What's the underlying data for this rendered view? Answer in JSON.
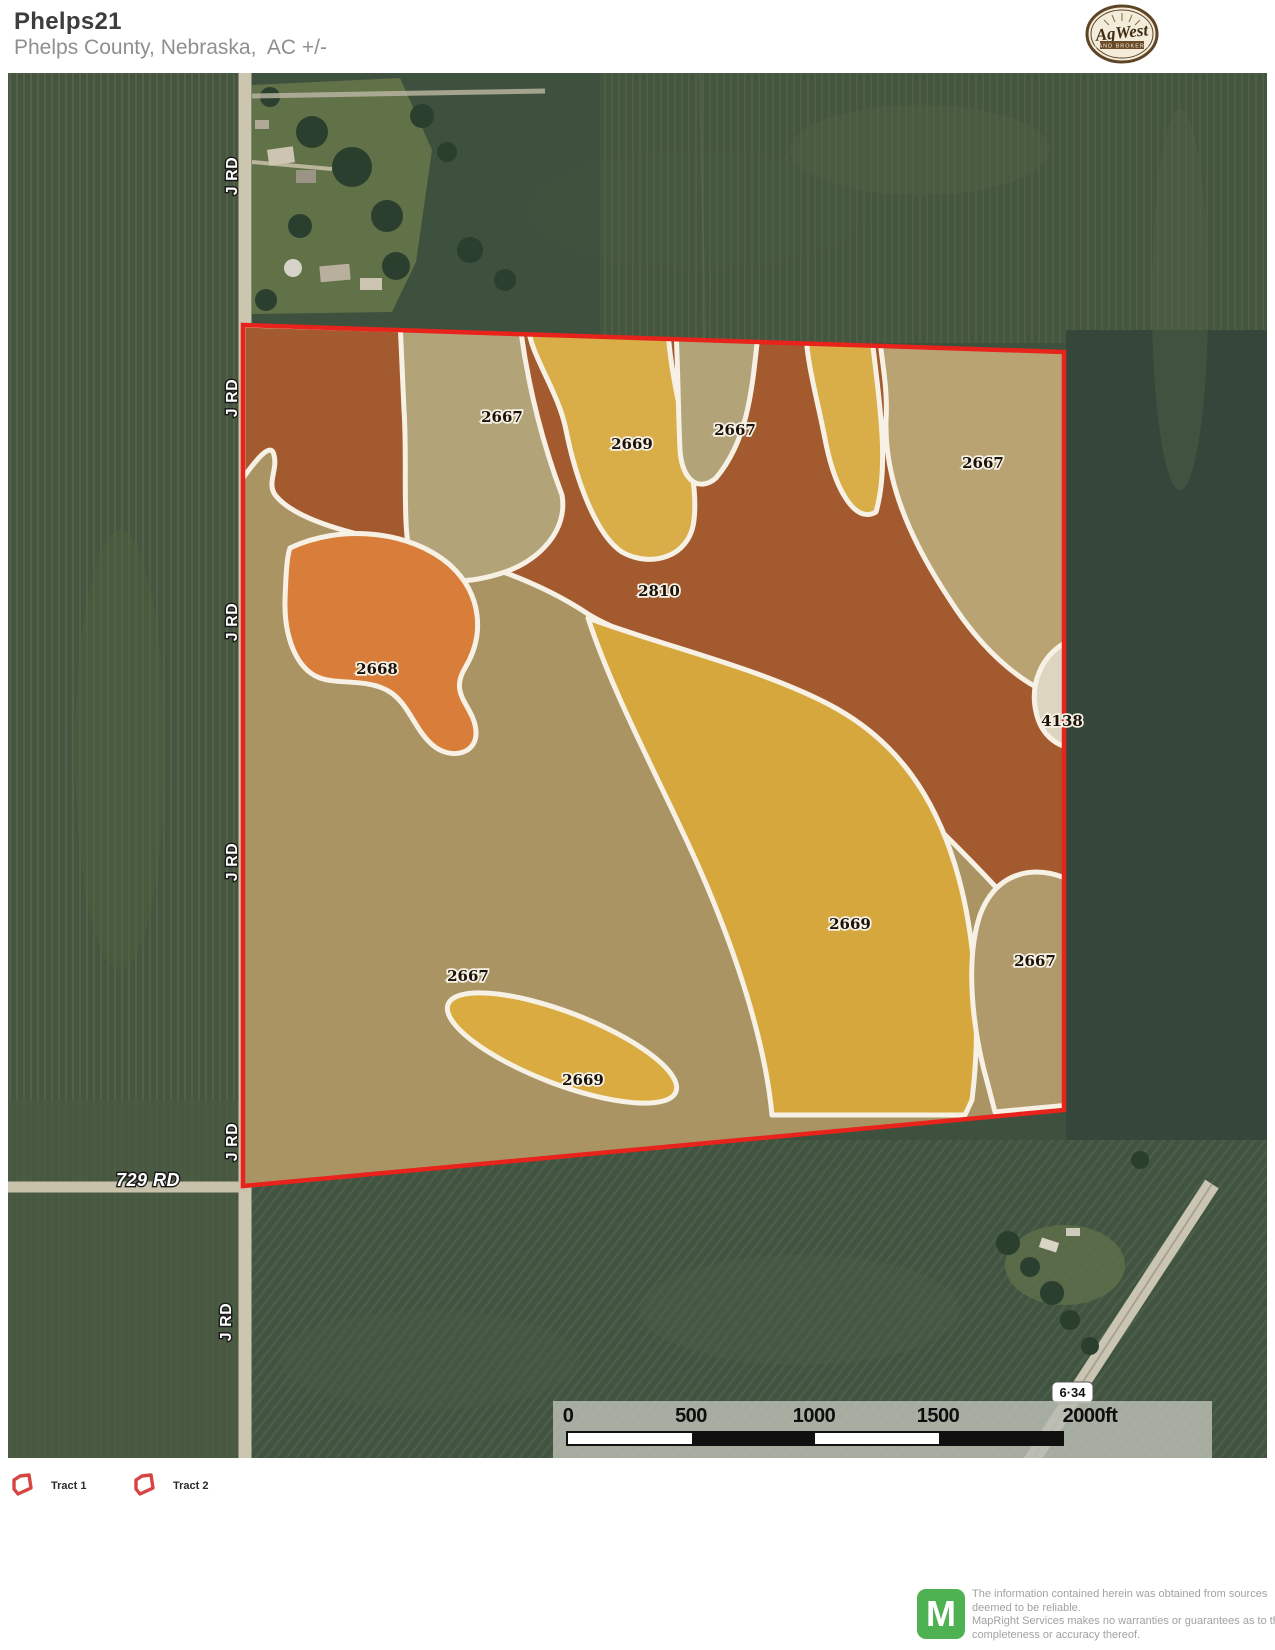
{
  "header": {
    "title": "Phelps21",
    "subtitle": "Phelps County, Nebraska,  AC +/-"
  },
  "brand": {
    "name": "AgWest",
    "tagline": "LAND BROKERS"
  },
  "map": {
    "boundary_color": "#e8231c",
    "zones": [
      {
        "code": "2667",
        "color": "#b2a379"
      },
      {
        "code": "2669",
        "color": "#d9ad47"
      },
      {
        "code": "2667",
        "color": "#b2a379"
      },
      {
        "code": "2667",
        "color": "#b9a372"
      },
      {
        "code": "2810",
        "color": "#a35a2e"
      },
      {
        "code": "2668",
        "color": "#d87e3a"
      },
      {
        "code": "4138",
        "color": "#ddd5c0"
      },
      {
        "code": "2669",
        "color": "#d6a73d"
      },
      {
        "code": "2667",
        "color": "#b09a6b"
      },
      {
        "code": "2667",
        "color": "#aa9464"
      },
      {
        "code": "2669",
        "color": "#d9ab41"
      }
    ],
    "roads": {
      "vertical": "J RD",
      "bottom": "729 RD",
      "highway": "6·34"
    },
    "scale_ticks": [
      "0",
      "500",
      "1000",
      "1500",
      "2000ft"
    ]
  },
  "legend": {
    "icon_color": "#d64541",
    "items": [
      {
        "label": "Tract 1"
      },
      {
        "label": "Tract 2"
      }
    ]
  },
  "footer": {
    "logo_letter": "M",
    "lines": [
      "The information contained herein was obtained from sources",
      "deemed to be reliable.",
      " MapRight Services makes no warranties or guarantees as to the",
      "completeness or accuracy thereof."
    ]
  }
}
